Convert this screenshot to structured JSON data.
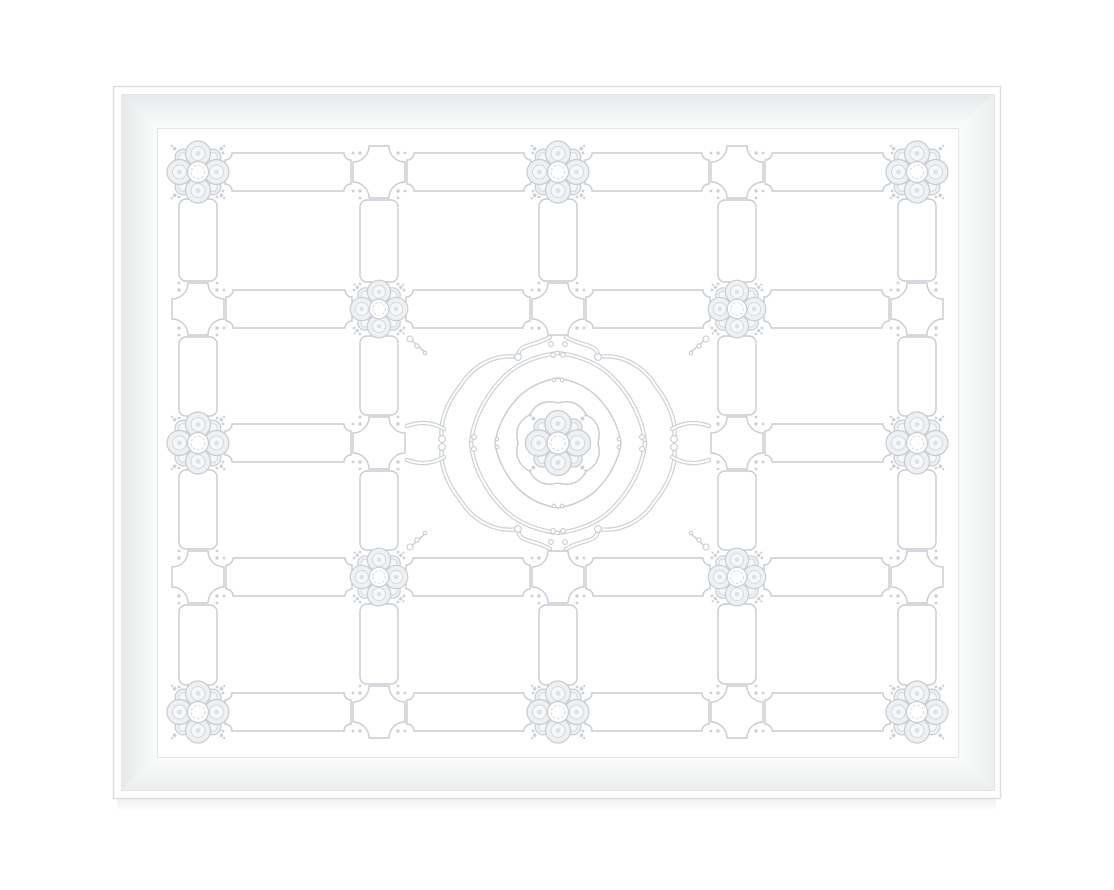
{
  "artwork": {
    "background": "#ffffff",
    "frame": {
      "outer_rect": {
        "x": 113,
        "y": 86,
        "w": 887,
        "h": 712
      },
      "inner_rect": {
        "x": 121,
        "y": 94,
        "w": 873,
        "h": 696
      },
      "opening_rect": {
        "x": 157,
        "y": 128,
        "w": 801,
        "h": 629
      },
      "colors": {
        "outline": "#dcdee0",
        "inline": "#e1e3e5",
        "face_dark": "#e6e8e9",
        "face_mid": "#eceeef",
        "face_light": "#fbfcfc",
        "opening_line": "#e3e5e7",
        "shadow": "rgba(0,0,0,0.06)"
      }
    },
    "pattern": {
      "colors": {
        "line": "#c7ccd1",
        "line_soft": "#d4d8dc",
        "strap": "#ccd1d5",
        "petal_fill": "#eef0f2",
        "petal_inner_fill": "#f6f7f8",
        "dot_soft": "#dde1e4",
        "field": "#ffffff"
      },
      "grid": {
        "cols": [
          198,
          379,
          558,
          737,
          917
        ],
        "rows": [
          172,
          309,
          443,
          577,
          712
        ],
        "band_half": 19,
        "corner_radius": 7,
        "gap_rosette": 27,
        "gap_knot": 28,
        "gap_medallion": 30
      },
      "knot": {
        "half_size": 26,
        "corner_radius": 16
      },
      "rosette": {
        "base_radius": 31,
        "large_scale": 1.0,
        "small_scale": 0.93,
        "center_scale": 1.05
      },
      "nodes": {
        "large_rosettes": [
          [
            0,
            0
          ],
          [
            2,
            0
          ],
          [
            4,
            0
          ],
          [
            0,
            2
          ],
          [
            4,
            2
          ],
          [
            0,
            4
          ],
          [
            2,
            4
          ],
          [
            4,
            4
          ]
        ],
        "small_rosettes": [
          [
            1,
            1
          ],
          [
            3,
            1
          ],
          [
            1,
            3
          ],
          [
            3,
            3
          ]
        ],
        "knots": [
          [
            1,
            0
          ],
          [
            3,
            0
          ],
          [
            0,
            1
          ],
          [
            2,
            1
          ],
          [
            4,
            1
          ],
          [
            1,
            2
          ],
          [
            3,
            2
          ],
          [
            0,
            3
          ],
          [
            2,
            3
          ],
          [
            4,
            3
          ],
          [
            1,
            4
          ],
          [
            3,
            4
          ]
        ],
        "medallion": [
          2,
          2
        ]
      },
      "medallion": {
        "center": [
          558,
          443
        ]
      }
    }
  }
}
